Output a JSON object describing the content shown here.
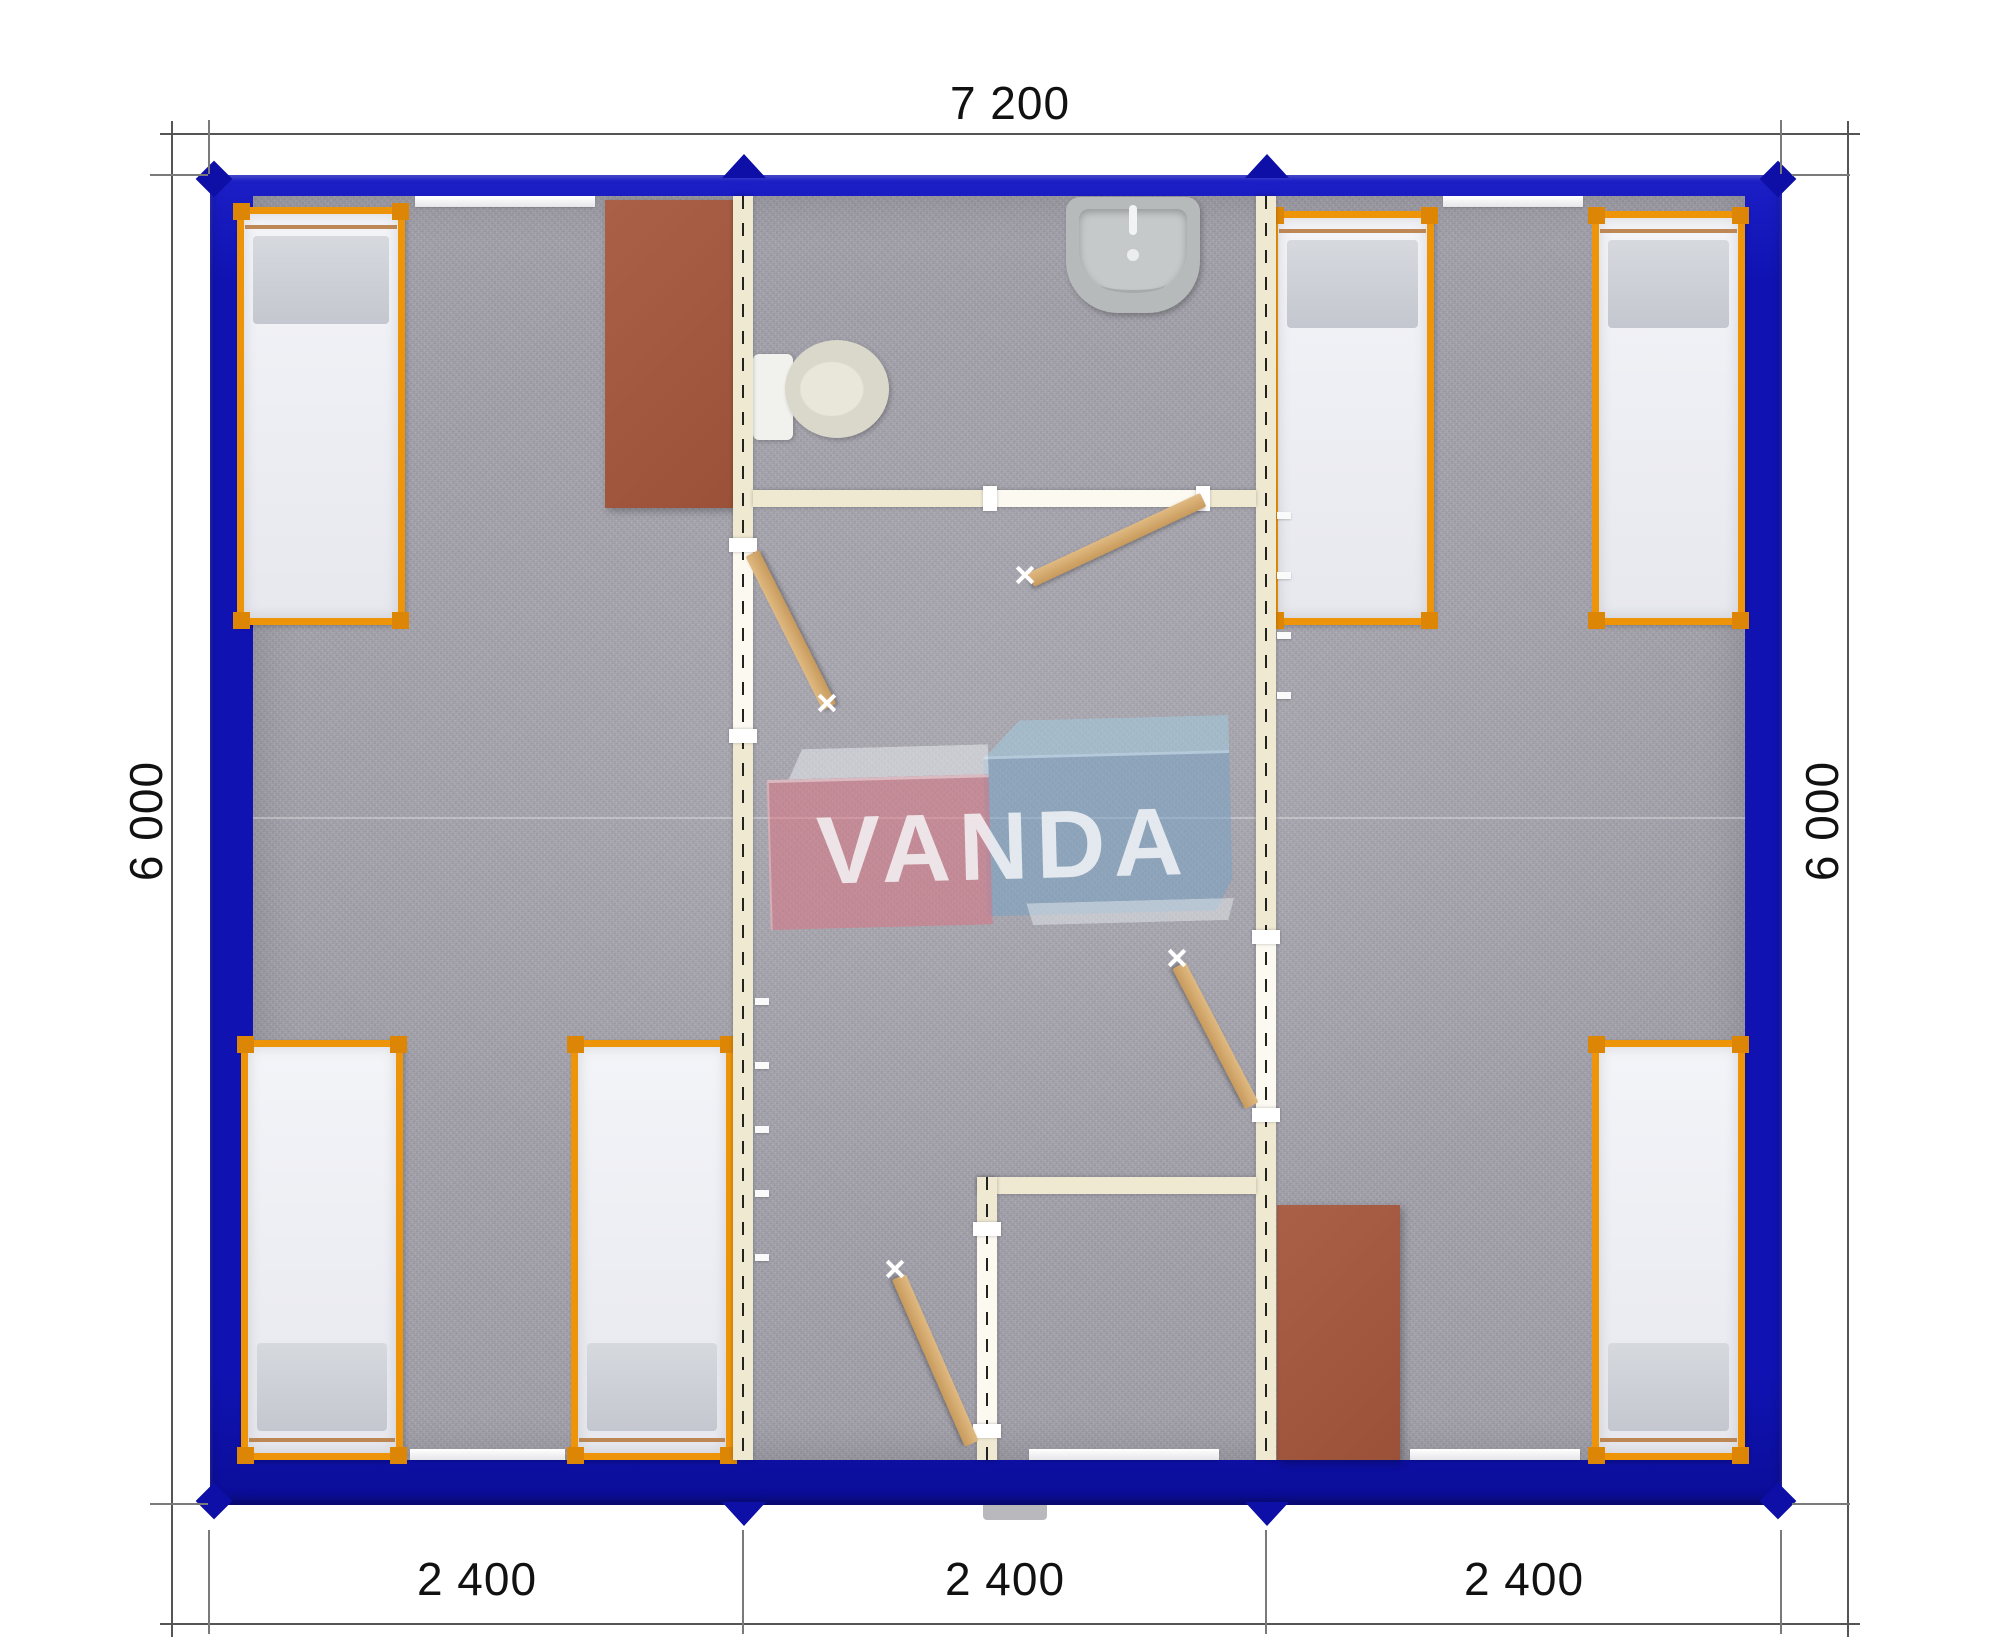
{
  "dimensions": {
    "top": "7 200",
    "left": "6 000",
    "right": "6 000",
    "bottom": [
      "2 400",
      "2 400",
      "2 400"
    ]
  },
  "watermark": {
    "text": "VANDA"
  },
  "colors": {
    "frame-blue": "#1013b2",
    "frame-blue-dark": "#0d0fa6",
    "bed-orange": "#ee9408",
    "bed-orange-dark": "#dd8606",
    "pillow-gray": "#c4c7cf",
    "wall-cream": "#f0e9d2",
    "table-brown": "#9a5138",
    "door-tan": "#c89a5c",
    "carpet-gray": "#a19fa8",
    "ceramic": "#d9d8ca",
    "sink-gray": "#b7babb",
    "dim-line": "#555555",
    "dim-text": "#111111"
  }
}
